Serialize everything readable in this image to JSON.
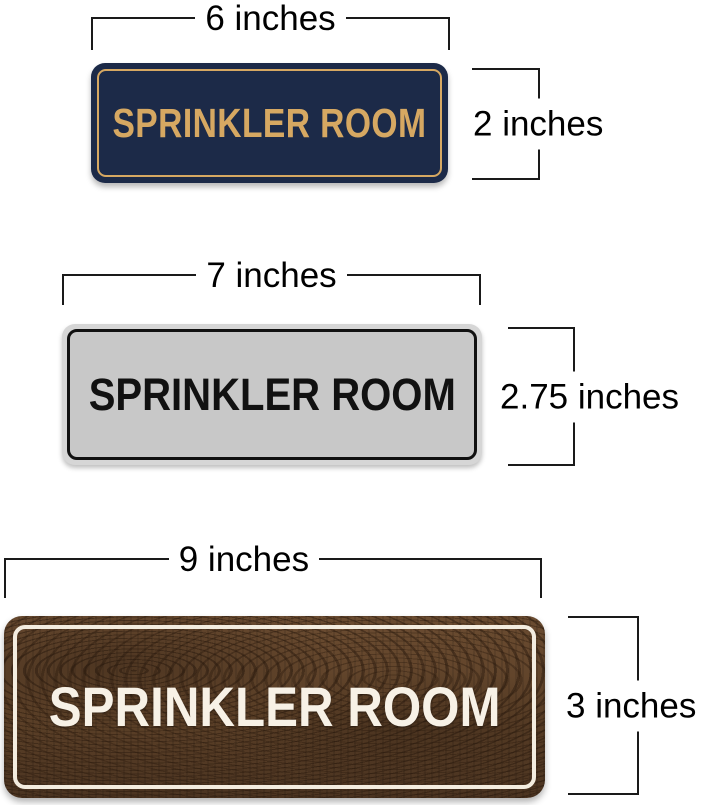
{
  "theme_colors": {
    "navy-bg": "#1c2a48",
    "gold": "#d6a862",
    "silver-frame": "#d6d6d6",
    "silver-face": "#c8c8c8",
    "ink": "#111111",
    "wood-dark": "#4b3421",
    "wood-mid": "#5d4128",
    "wood-light": "#6b4c31",
    "cream": "#f3ecdf",
    "dim-line": "#1a1a1a"
  },
  "signs": [
    {
      "name": "navy-gold-sign",
      "text": "SPRINKLER ROOM",
      "width_label": "6 inches",
      "height_label": "2 inches"
    },
    {
      "name": "silver-black-sign",
      "text": "SPRINKLER ROOM",
      "width_label": "7 inches",
      "height_label": "2.75 inches"
    },
    {
      "name": "walnut-white-sign",
      "text": "SPRINKLER ROOM",
      "width_label": "9 inches",
      "height_label": "3 inches"
    }
  ]
}
